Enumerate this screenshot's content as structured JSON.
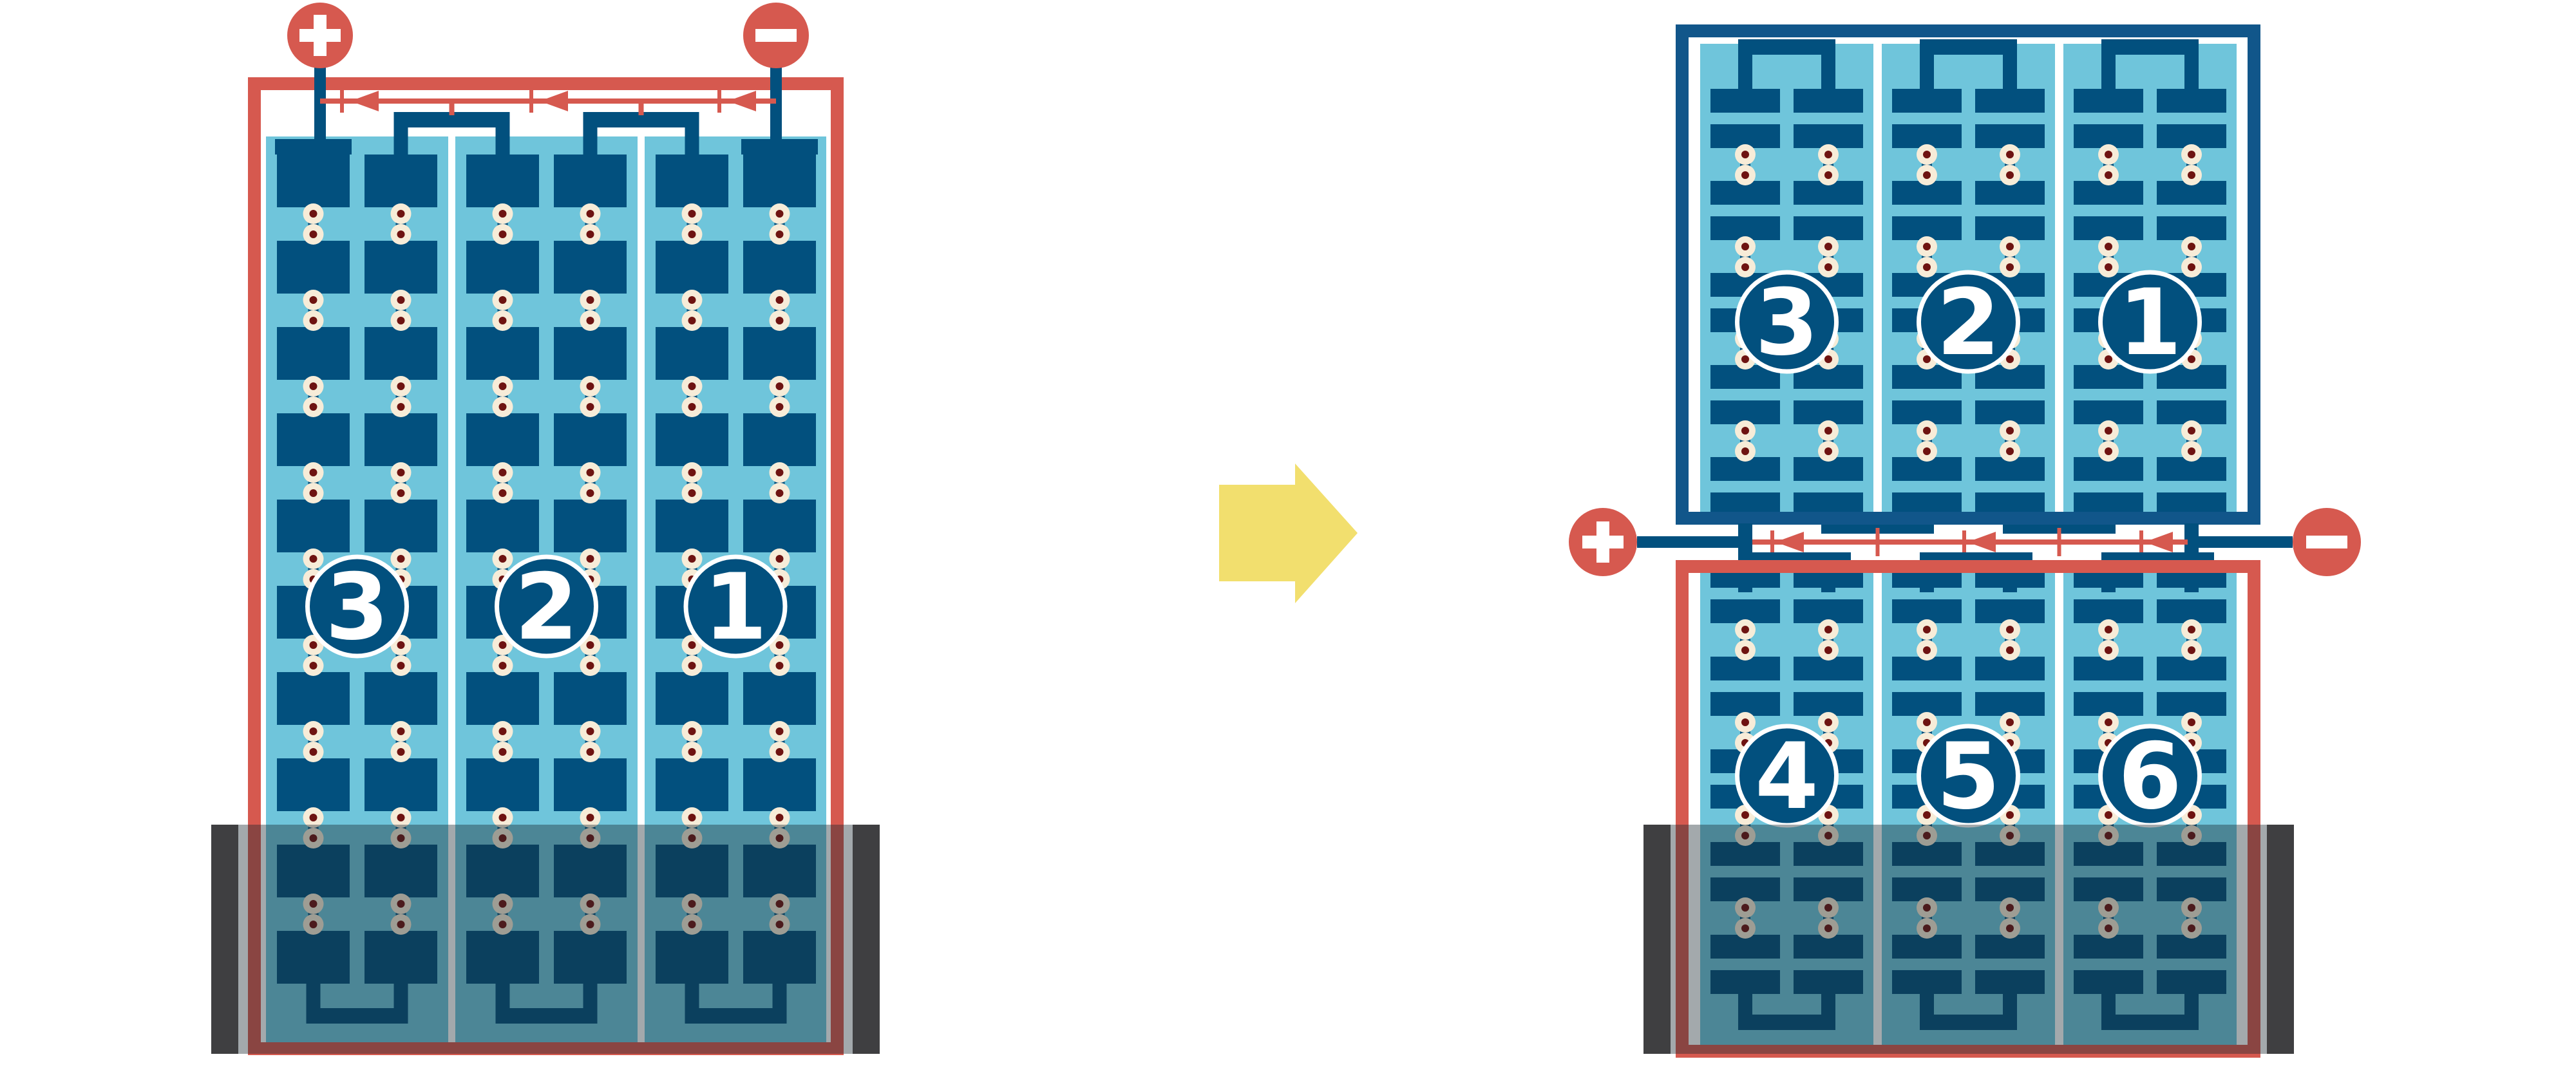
{
  "colors": {
    "background": "#FFFFFF",
    "red": "#D6594F",
    "navy": "#02507E",
    "frame_blue": "#11568A",
    "light_blue": "#6FC5DB",
    "cream": "#F7ECD8",
    "maroon": "#6E1311",
    "yellow": "#F2DF6E",
    "overlay": "rgba(25,40,48,0.40)",
    "clamp_gray": "#3F3F41",
    "white": "#FFFFFF",
    "label_text": "#FFFFFF"
  },
  "left_battery": {
    "terminal_plus_symbol": "+",
    "terminal_minus_symbol": "−",
    "cell_labels": [
      "3",
      "2",
      "1"
    ],
    "submerged": true
  },
  "transform_arrow": {
    "direction": "right",
    "color": "#F2DF6E"
  },
  "right_assembly": {
    "terminal_plus_symbol": "+",
    "terminal_minus_symbol": "−",
    "top_battery": {
      "cell_labels": [
        "3",
        "2",
        "1"
      ]
    },
    "bottom_battery": {
      "cell_labels": [
        "4",
        "5",
        "6"
      ],
      "submerged": true
    }
  }
}
